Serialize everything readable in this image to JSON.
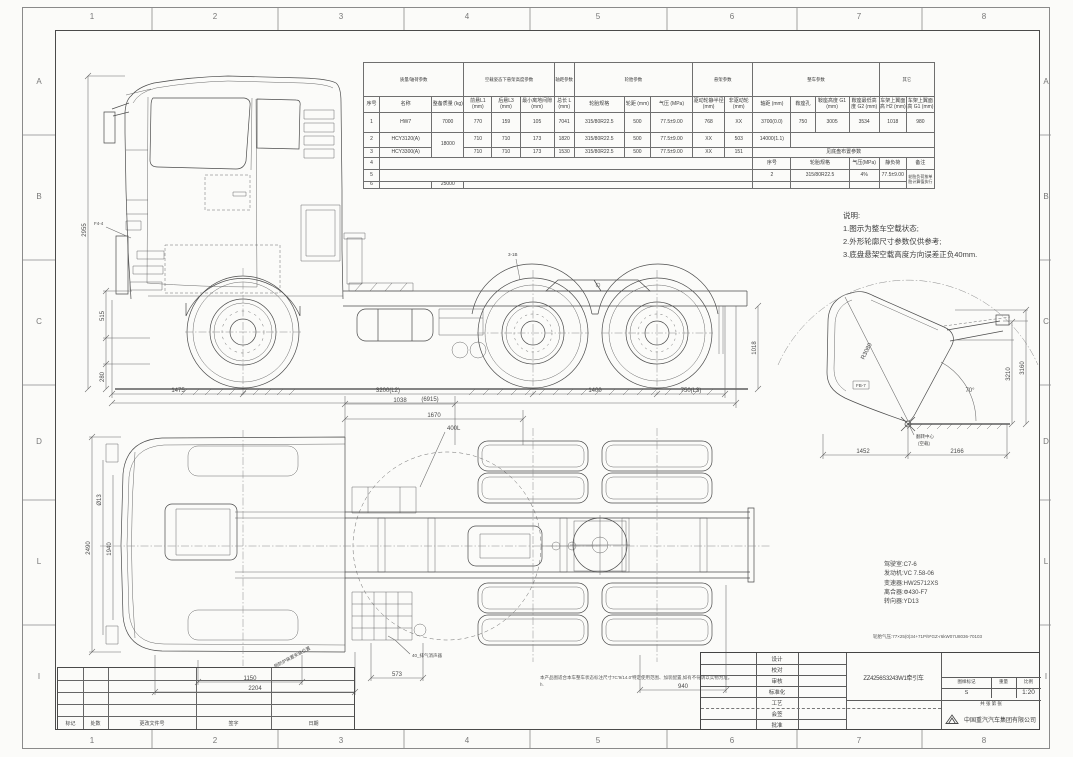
{
  "border": {
    "cols": [
      "1",
      "2",
      "3",
      "4",
      "5",
      "6",
      "7",
      "8"
    ],
    "rows": [
      "A",
      "B",
      "C",
      "D",
      "L",
      "I"
    ]
  },
  "param_table": {
    "rows": [
      [
        {
          "t": "质量/轴荷参数",
          "cs": 3
        },
        {
          "t": "空载姿态下悬架高度参数",
          "cs": 3
        },
        {
          "t": "轴距参数"
        },
        {
          "t": "轮胎参数",
          "cs": 3
        },
        {
          "t": "悬架参数",
          "cs": 2
        },
        {
          "t": "整车参数",
          "cs": 4
        },
        {
          "t": "其它",
          "cs": 2
        }
      ],
      [
        "序号",
        "名称",
        "整备质量 (kg)",
        "前悬L1 (mm)",
        "后悬L3 (mm)",
        "最小离地间隙 (mm)",
        "总长 L (mm)",
        "轮胎规格",
        "轮距 (mm)",
        "气压 (MPa)",
        "驱动轮静半径 (mm)",
        "非驱动轮 (mm)",
        "轴距 (mm)",
        "鞍座孔",
        "鞍座高度 G1 (mm)",
        "鞍座最低高度 G2 (mm)",
        "车架上翼面高 H2 (mm)",
        "车架上翼面高 G1 (mm)"
      ],
      [
        "1",
        "HW7",
        "7000",
        "770",
        "159",
        "105",
        "7041",
        "315/80R22.5",
        "500",
        "77.5±9.00",
        "768",
        "XX",
        "3700(0.0)",
        "750",
        "3005",
        "3534",
        "1018",
        "980"
      ],
      [
        "2",
        "HCY3120(A)",
        {
          "t": "18000",
          "rs": 2
        },
        "710",
        "710",
        "173",
        "1820",
        "315/80R22.5",
        "500",
        "77.5±9.00",
        "XX",
        "503",
        "14000(1.1)",
        {
          "t": "",
          "cs": 5
        }
      ],
      [
        "3",
        "HCY3300(A)",
        "710",
        "710",
        "173",
        "1530",
        "315/80R22.5",
        "500",
        "77.5±9.00",
        "XX",
        "151",
        {
          "t": "见底盘布置参数",
          "cs": 6
        }
      ],
      [
        "4",
        {
          "t": "",
          "cs": 11
        },
        "序号",
        {
          "t": "轮胎规格",
          "cs": 2
        },
        "气压(MPa)",
        "静负荷",
        "备注"
      ],
      [
        "5",
        {
          "t": "",
          "cs": 11
        },
        "2",
        {
          "t": "315/80R22.5",
          "cs": 2
        },
        "4%",
        "77.5±9.00",
        {
          "t": "轮胎负荷按单胎计算值执行",
          "rs": 2,
          "cls": "rm"
        }
      ],
      [
        "6",
        "",
        "25000",
        {
          "t": "",
          "cs": 9
        },
        "",
        {
          "t": "",
          "cs": 2
        },
        "",
        ""
      ]
    ]
  },
  "notes": {
    "title": "说明:",
    "n1": "1.图示为整车空载状态;",
    "n2": "2.外形轮廓尺寸参数仅供参考;",
    "n3": "3.底盘悬架空载高度方向误差正负40mm."
  },
  "side_view": {
    "d1": "1475",
    "d2": "3200(L2)",
    "d3": "1400",
    "d4": "750(L3)",
    "overall": "(6915)",
    "v1": "515",
    "v2": "280",
    "v3": "2955",
    "v4": "1018",
    "f4": "F4-4",
    "b3": "3-1B"
  },
  "top_view": {
    "t1": "1038",
    "t2": "1670",
    "tank": "400L",
    "l1": "2490",
    "l2": "Ø13",
    "l3": "1940",
    "b1": "1150",
    "b2": "2204",
    "b3": "573",
    "b4": "940",
    "muffler": "40_排气消声器",
    "guard": "侧防护装置安装位置"
  },
  "tilt_view": {
    "radius": "R3080",
    "angle": "70°",
    "v1": "3210",
    "v2": "3160",
    "b1": "1452",
    "b2": "2166",
    "pivot": "翻转中心",
    "pivot2": "(空载)",
    "fb": "FB-7"
  },
  "specs": {
    "s1": "驾驶室:C7-6",
    "s2": "发动机:VC 7.58-06",
    "s3": "变速器:HW25712XS",
    "s4": "离合器:Φ430-F7",
    "s5": "转向器:YD13",
    "tire": "轮胎气压:77×25(0)34+71P/9*GZ-r6kW07U8036-70103"
  },
  "footnote": {
    "l1": "本产品图适合本车整车状态标注尺寸7C'9/14.0'特定使用范围、加装配置,如有不符请以实物为准。",
    "l2": "h."
  },
  "title_block": {
    "roles": [
      "设计",
      "校对",
      "审核",
      "标准化",
      "工艺",
      "会签",
      "批准"
    ],
    "title": "ZZ4256S3243W1牵引车",
    "mark_label": "图样标记",
    "weight_label": "重量",
    "scale_label": "比例",
    "mark": "S",
    "scale": "1:20",
    "sheet": "共 张 第 张",
    "company": "中国重汽汽车集团有限公司"
  },
  "revision": {
    "labels": [
      "标记",
      "处数",
      "更改文件号",
      "签字",
      "日期"
    ]
  }
}
